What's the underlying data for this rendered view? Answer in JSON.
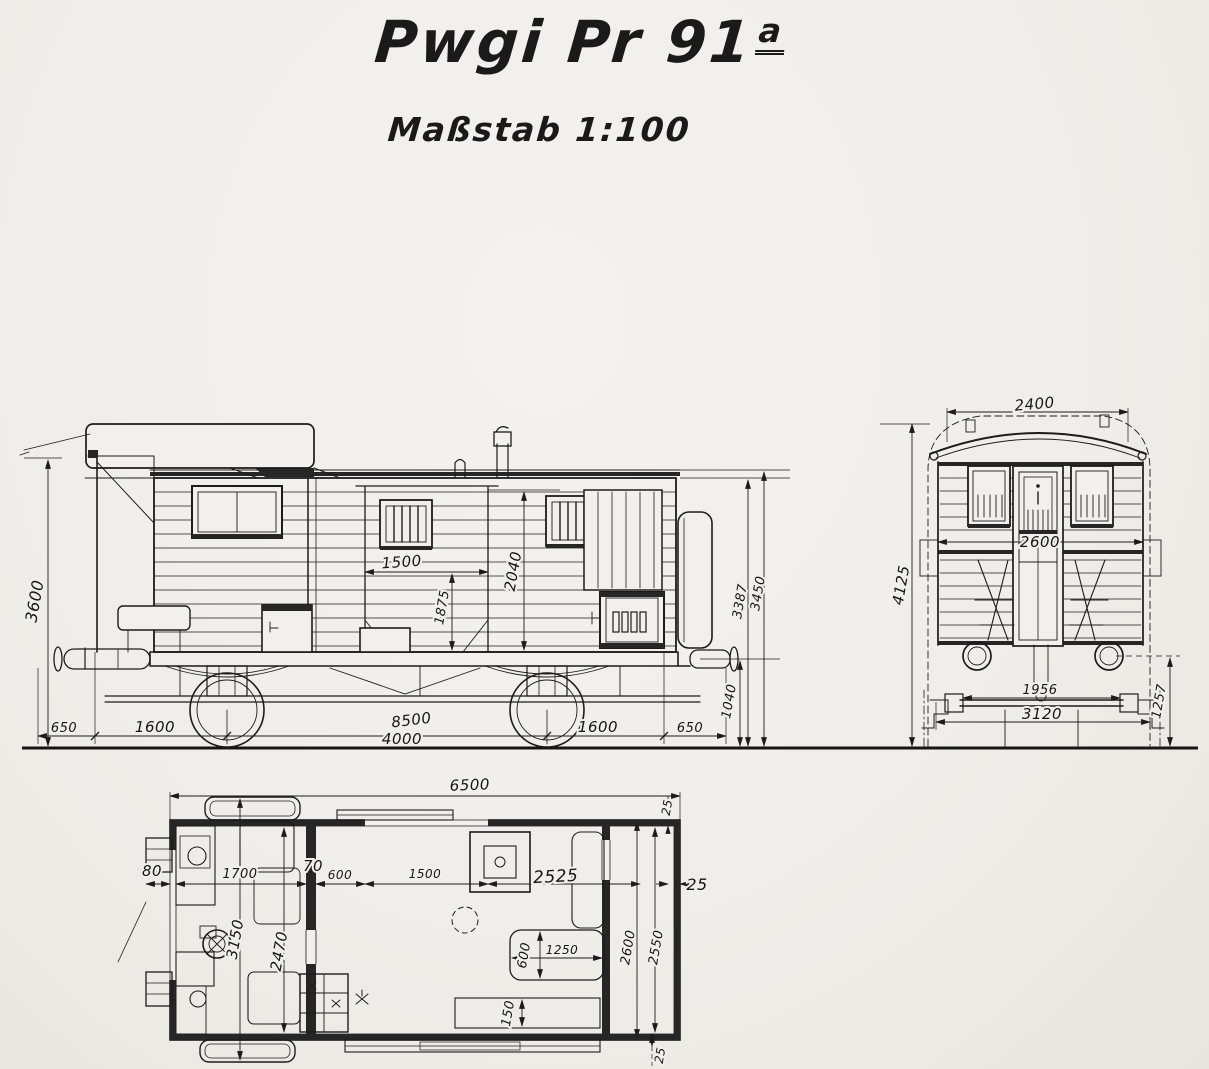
{
  "title": {
    "main": "Pwgi Pr 91",
    "superscript": "a"
  },
  "subtitle": "Maßstab 1:100",
  "side_view": {
    "dims": {
      "height_body": "3600",
      "door_opening_width": "1500",
      "door_leaf_height": "1875",
      "doorway_height": "2040",
      "height_eaves": "3387",
      "height_roof": "3450",
      "buffer_height": "1040",
      "overhang_left": "650",
      "axle_to_end_left": "1600",
      "length_over_buffers": "8500",
      "wheelbase": "4000",
      "axle_to_end_right": "1600",
      "overhang_right": "650"
    }
  },
  "end_view": {
    "dims": {
      "roof_width": "2400",
      "height_total": "4125",
      "body_width": "2600",
      "axle_journal_spacing": "1956",
      "width_over_steps": "3120",
      "buffer_center_height": "1257"
    }
  },
  "plan_view": {
    "dims": {
      "length_total": "6500",
      "wall_top": "25",
      "end_overhang_left": "80",
      "service_compartment": "1700",
      "partition_thickness": "70",
      "door_width": "600",
      "door_opening": "1500",
      "freight_section": "2525",
      "wall_right": "25",
      "width_over_steps": "3150",
      "width_interior": "2470",
      "bench_width": "600",
      "bench_length": "1250",
      "ledge": "150",
      "width_body": "2600",
      "width_inner": "2550",
      "wall_bottom": "25"
    }
  }
}
